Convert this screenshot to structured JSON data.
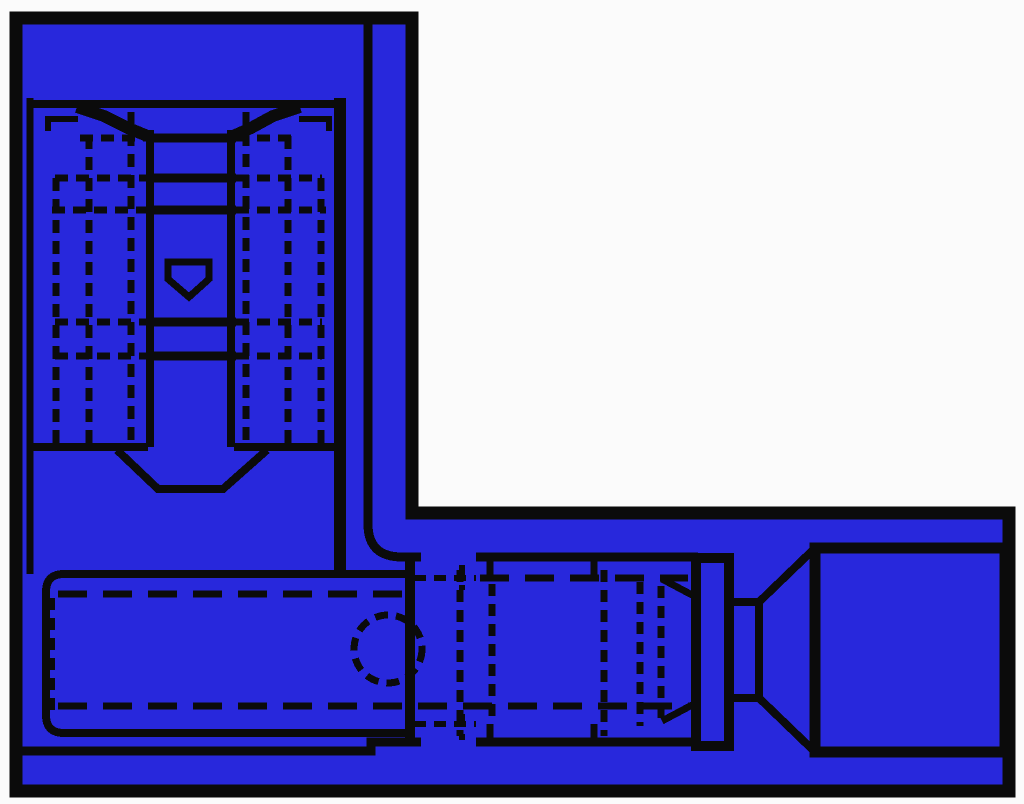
{
  "colors": {
    "background": "#fbfbfb",
    "fill": "#2828DC",
    "line": "#0b0b0b"
  },
  "diagram": {
    "kind": "pixelated technical line drawing",
    "subject": "insulated quick-disconnect terminal, two orthographic views on an L-shaped blue sheet"
  },
  "parts": {
    "sheet": "blue L-shaped drawing sheet",
    "top_view": "terminal top view with entry funnel, center channel and hidden crimp-wing lines",
    "funnel": "wire entry funnel",
    "channel": "center blade channel",
    "pentagon_detent": "detent tab outline",
    "transition_taper": "transition taper below crimp area",
    "corner_guide": "inner guide line along sheet corner",
    "side_view": "terminal side view",
    "insulation_barrel": "insulation grip barrel",
    "inspection_hole": "hidden inspection hole",
    "crimp_sleeve": "crimped metal sleeve section",
    "flange": "stop flange",
    "neck": "narrow neck",
    "entry_funnel": "flared entry funnel",
    "receptacle": "receptacle body"
  }
}
